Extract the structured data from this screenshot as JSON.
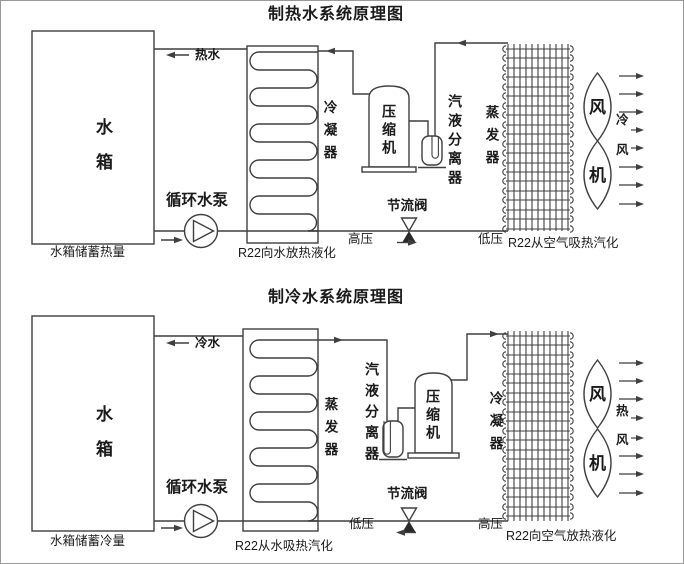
{
  "canvas": {
    "width": 684,
    "height": 564
  },
  "colors": {
    "line": "#3f3f3f",
    "text": "#1a1a1a",
    "background": "#ffffff",
    "border": "#9a9a9a"
  },
  "heating": {
    "title": "制热水系统原理图",
    "tank_label": "水箱",
    "tank_caption": "水箱储蓄热量",
    "water_label": "热水",
    "pump_label": "循环水泵",
    "water_coil_label": "冷凝器",
    "water_coil_caption": "R22向水放热液化",
    "compressor_label": "压缩机",
    "separator_label": "汽液分离器",
    "valve_label": "节流阀",
    "pressure_left": "高压",
    "pressure_right": "低压",
    "air_coil_label": "蒸发器",
    "air_coil_caption": "R22从空气吸热汽化",
    "fan_char_top": "风",
    "fan_char_bottom": "机",
    "air_char_1": "冷",
    "air_char_2": "风"
  },
  "cooling": {
    "title": "制冷水系统原理图",
    "tank_label": "水箱",
    "tank_caption": "水箱储蓄冷量",
    "water_label": "冷水",
    "pump_label": "循环水泵",
    "water_coil_label": "蒸发器",
    "water_coil_caption": "R22从水吸热汽化",
    "compressor_label": "压缩机",
    "separator_label": "汽液分离器",
    "valve_label": "节流阀",
    "pressure_left": "低压",
    "pressure_right": "高压",
    "air_coil_label": "冷凝器",
    "air_coil_caption": "R22向空气放热液化",
    "fan_char_top": "风",
    "fan_char_bottom": "机",
    "air_char_1": "热",
    "air_char_2": "风"
  }
}
